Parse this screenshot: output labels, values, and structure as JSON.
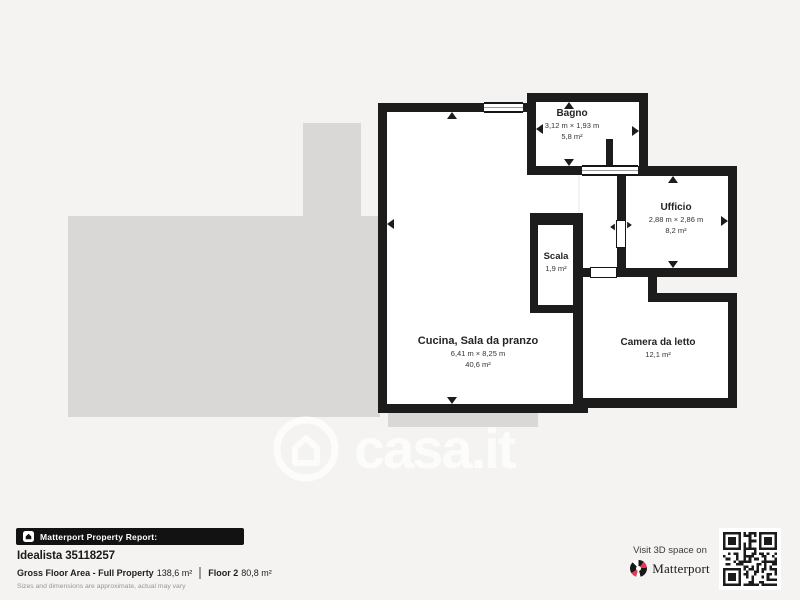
{
  "colors": {
    "canvas": "#f4f3f1",
    "silhouette": "#d9d8d6",
    "wall": "#1c1c1c",
    "accent_red": "#e23a56",
    "bar_black": "#121212"
  },
  "watermark": {
    "text": "casa.it",
    "icon": "house-circle-icon"
  },
  "rooms": [
    {
      "id": "bagno",
      "name": "Bagno",
      "dims": "3,12 m × 1,93 m",
      "area": "5,8 m²"
    },
    {
      "id": "ufficio",
      "name": "Ufficio",
      "dims": "2,88 m × 2,86 m",
      "area": "8,2 m²"
    },
    {
      "id": "scala",
      "name": "Scala",
      "area": "1,9 m²"
    },
    {
      "id": "cucina",
      "name": "Cucina, Sala da pranzo",
      "dims": "6,41 m × 8,25 m",
      "area": "40,6 m²"
    },
    {
      "id": "camera",
      "name": "Camera da letto",
      "area": "12,1 m²"
    }
  ],
  "report": {
    "header": "Matterport Property Report:",
    "listing": "Idealista 35118257",
    "gfa_label": "Gross Floor Area - Full Property",
    "gfa_value": "138,6 m²",
    "floor_label": "Floor 2",
    "floor_value": "80,8 m²",
    "disclaimer": "Sizes and dimensions are approximate, actual may vary"
  },
  "promo": {
    "visit": "Visit 3D space on",
    "brand": "Matterport"
  }
}
